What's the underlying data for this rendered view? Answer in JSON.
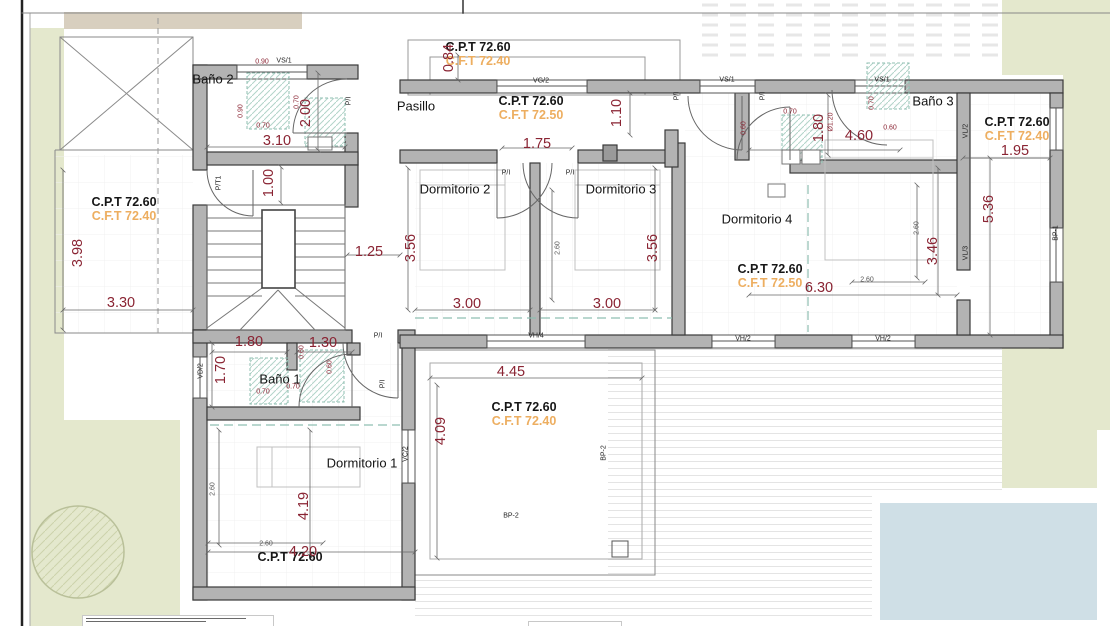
{
  "drawing": {
    "type": "architectural floor plan (upper level)",
    "rooms": [
      "Baño 2",
      "Pasillo",
      "Dormitorio 2",
      "Dormitorio 3",
      "Dormitorio 4",
      "Baño 3",
      "Baño 1",
      "Dormitorio 1"
    ],
    "colors": {
      "dimension_red": "#8a2433",
      "cft_orange": "#edae60",
      "wall_gray": "#b3b3b3",
      "garden_green": "#e4e8cd",
      "pool_blue": "#cfdfe6",
      "fixture_teal": "#8fbfb2"
    }
  },
  "labels": [
    {
      "name": "room-bano2",
      "text": "Baño 2",
      "x": 213,
      "y": 79,
      "cls": "room"
    },
    {
      "name": "room-pasillo",
      "text": "Pasillo",
      "x": 416,
      "y": 106,
      "cls": "room"
    },
    {
      "name": "room-dormitorio2",
      "text": "Dormitorio 2",
      "x": 455,
      "y": 189,
      "cls": "room"
    },
    {
      "name": "room-dormitorio3",
      "text": "Dormitorio 3",
      "x": 621,
      "y": 189,
      "cls": "room"
    },
    {
      "name": "room-dormitorio4",
      "text": "Dormitorio 4",
      "x": 757,
      "y": 219,
      "cls": "room"
    },
    {
      "name": "room-bano3",
      "text": "Baño 3",
      "x": 933,
      "y": 101,
      "cls": "room"
    },
    {
      "name": "room-bano1",
      "text": "Baño 1",
      "x": 280,
      "y": 379,
      "cls": "room"
    },
    {
      "name": "room-dormitorio1",
      "text": "Dormitorio 1",
      "x": 362,
      "y": 463,
      "cls": "room"
    },
    {
      "name": "cpt-top-porch",
      "text": "C.P.T 72.60",
      "x": 478,
      "y": 47,
      "cls": "cpt"
    },
    {
      "name": "cft-top-porch",
      "text": "C.F.T 72.40",
      "x": 478,
      "y": 61,
      "cls": "cft"
    },
    {
      "name": "cpt-pasillo",
      "text": "C.P.T 72.60",
      "x": 531,
      "y": 101,
      "cls": "cpt"
    },
    {
      "name": "cft-pasillo",
      "text": "C.F.T 72.50",
      "x": 531,
      "y": 115,
      "cls": "cft"
    },
    {
      "name": "cpt-left-porch",
      "text": "C.P.T 72.60",
      "x": 124,
      "y": 202,
      "cls": "cpt"
    },
    {
      "name": "cft-left-porch",
      "text": "C.F.T 72.40",
      "x": 124,
      "y": 216,
      "cls": "cft"
    },
    {
      "name": "cpt-dormitorio4",
      "text": "C.P.T 72.60",
      "x": 770,
      "y": 269,
      "cls": "cpt"
    },
    {
      "name": "cft-dormitorio4",
      "text": "C.F.T 72.50",
      "x": 770,
      "y": 283,
      "cls": "cft"
    },
    {
      "name": "cpt-right-terrace",
      "text": "C.P.T 72.60",
      "x": 1017,
      "y": 122,
      "cls": "cpt"
    },
    {
      "name": "cft-right-terrace",
      "text": "C.F.T 72.40",
      "x": 1017,
      "y": 136,
      "cls": "cft"
    },
    {
      "name": "cpt-bottom-terrace",
      "text": "C.P.T 72.60",
      "x": 524,
      "y": 407,
      "cls": "cpt"
    },
    {
      "name": "cft-bottom-terrace",
      "text": "C.F.T 72.40",
      "x": 524,
      "y": 421,
      "cls": "cft"
    },
    {
      "name": "cpt-dormitorio1",
      "text": "C.P.T 72.60",
      "x": 290,
      "y": 557,
      "cls": "cpt"
    },
    {
      "name": "dim-bano2-width",
      "text": "3.10",
      "x": 277,
      "y": 141,
      "cls": "dim"
    },
    {
      "name": "dim-bano2-depth",
      "text": "2.00",
      "x": 306,
      "y": 113,
      "cls": "dim",
      "rot": 1
    },
    {
      "name": "dim-hall-width",
      "text": "1.00",
      "x": 269,
      "y": 183,
      "cls": "dim",
      "rot": 1
    },
    {
      "name": "dim-porch-depth",
      "text": "0.84",
      "x": 449,
      "y": 58,
      "cls": "dim",
      "rot": 1
    },
    {
      "name": "dim-corridor",
      "text": "1.10",
      "x": 617,
      "y": 113,
      "cls": "dim",
      "rot": 1
    },
    {
      "name": "dim-pasillo-doors",
      "text": "1.75",
      "x": 537,
      "y": 144,
      "cls": "dim"
    },
    {
      "name": "dim-dorm2-depth",
      "text": "3.56",
      "x": 411,
      "y": 248,
      "cls": "dim",
      "rot": 1
    },
    {
      "name": "dim-dorm3-depth",
      "text": "3.56",
      "x": 653,
      "y": 248,
      "cls": "dim",
      "rot": 1
    },
    {
      "name": "dim-dorm2-width",
      "text": "3.00",
      "x": 467,
      "y": 304,
      "cls": "dim"
    },
    {
      "name": "dim-dorm3-width",
      "text": "3.00",
      "x": 607,
      "y": 304,
      "cls": "dim"
    },
    {
      "name": "dim-stair-width",
      "text": "1.25",
      "x": 369,
      "y": 252,
      "cls": "dim"
    },
    {
      "name": "dim-leftporch-depth",
      "text": "3.98",
      "x": 78,
      "y": 253,
      "cls": "dim",
      "rot": 1
    },
    {
      "name": "dim-leftporch-width",
      "text": "3.30",
      "x": 121,
      "y": 303,
      "cls": "dim"
    },
    {
      "name": "dim-bano3-depth",
      "text": "1.80",
      "x": 819,
      "y": 128,
      "cls": "dim",
      "rot": 1
    },
    {
      "name": "dim-bano3-width",
      "text": "4.60",
      "x": 859,
      "y": 136,
      "cls": "dim"
    },
    {
      "name": "dim-dorm4-width",
      "text": "6.30",
      "x": 819,
      "y": 288,
      "cls": "dim"
    },
    {
      "name": "dim-dorm4-depth",
      "text": "3.46",
      "x": 933,
      "y": 251,
      "cls": "dim",
      "rot": 1
    },
    {
      "name": "dim-terrace1-depth",
      "text": "5.36",
      "x": 989,
      "y": 209,
      "cls": "dim",
      "rot": 1
    },
    {
      "name": "dim-terrace1-width",
      "text": "1.95",
      "x": 1015,
      "y": 151,
      "cls": "dim"
    },
    {
      "name": "dim-bano1-width-a",
      "text": "1.80",
      "x": 249,
      "y": 342,
      "cls": "dim"
    },
    {
      "name": "dim-bano1-width-b",
      "text": "1.30",
      "x": 323,
      "y": 343,
      "cls": "dim"
    },
    {
      "name": "dim-bano1-depth",
      "text": "1.70",
      "x": 221,
      "y": 370,
      "cls": "dim",
      "rot": 1
    },
    {
      "name": "dim-terrace2-width",
      "text": "4.45",
      "x": 511,
      "y": 372,
      "cls": "dim"
    },
    {
      "name": "dim-terrace2-depth",
      "text": "4.09",
      "x": 441,
      "y": 431,
      "cls": "dim",
      "rot": 1
    },
    {
      "name": "dim-dorm1-depth",
      "text": "4.19",
      "x": 304,
      "y": 506,
      "cls": "dim",
      "rot": 1
    },
    {
      "name": "dim-dorm1-width",
      "text": "4.20",
      "x": 303,
      "y": 552,
      "cls": "dim"
    },
    {
      "name": "dim-b2-shower-w",
      "text": "0.90",
      "x": 262,
      "y": 62,
      "cls": "dimsm"
    },
    {
      "name": "dim-b2-shower-d",
      "text": "0.90",
      "x": 241,
      "y": 111,
      "cls": "dimsm",
      "rot": 1
    },
    {
      "name": "dim-b2-fix-a",
      "text": "0.70",
      "x": 297,
      "y": 102,
      "cls": "dimsm",
      "rot": 1
    },
    {
      "name": "dim-b2-fix-b",
      "text": "0.70",
      "x": 263,
      "y": 126,
      "cls": "dimsm"
    },
    {
      "name": "dim-b3-fix-a",
      "text": "0.70",
      "x": 790,
      "y": 112,
      "cls": "dimsm"
    },
    {
      "name": "dim-b3-fix-b",
      "text": "0.70",
      "x": 872,
      "y": 103,
      "cls": "dimsm",
      "rot": 1
    },
    {
      "name": "dim-b3-fix-c",
      "text": "0.60",
      "x": 890,
      "y": 128,
      "cls": "dimsm"
    },
    {
      "name": "dim-b3-fix-d",
      "text": "0.60",
      "x": 744,
      "y": 128,
      "cls": "dimsm",
      "rot": 1
    },
    {
      "name": "dim-b3-shower-dia",
      "text": "Ø1.20",
      "x": 831,
      "y": 122,
      "cls": "dimsm",
      "rot": 1
    },
    {
      "name": "dim-b1-fix-a",
      "text": "0.70",
      "x": 263,
      "y": 392,
      "cls": "dimsm"
    },
    {
      "name": "dim-b1-fix-b",
      "text": "0.70",
      "x": 293,
      "y": 387,
      "cls": "dimsm"
    },
    {
      "name": "dim-b1-fix-c",
      "text": "0.60",
      "x": 330,
      "y": 367,
      "cls": "dimsm",
      "rot": 1
    },
    {
      "name": "dim-b1-fix-d",
      "text": "0.60",
      "x": 302,
      "y": 352,
      "cls": "dimsm",
      "rot": 1
    },
    {
      "name": "dim-d23-bed",
      "text": "2.60",
      "x": 558,
      "y": 248,
      "cls": "dimgray",
      "rot": 1
    },
    {
      "name": "dim-d4-bed-v",
      "text": "2.60",
      "x": 917,
      "y": 228,
      "cls": "dimgray",
      "rot": 1
    },
    {
      "name": "dim-d4-bed-h",
      "text": "2.60",
      "x": 867,
      "y": 280,
      "cls": "dimgray"
    },
    {
      "name": "dim-d1-bed-h",
      "text": "2.60",
      "x": 266,
      "y": 544,
      "cls": "dimgray"
    },
    {
      "name": "dim-d1-bed-v",
      "text": "2.60",
      "x": 213,
      "y": 489,
      "cls": "dimgray",
      "rot": 1
    },
    {
      "name": "tag-window-vs1-bano2",
      "text": "VS/1",
      "x": 284,
      "y": 61,
      "cls": "tag"
    },
    {
      "name": "tag-window-vg2",
      "text": "VG/2",
      "x": 541,
      "y": 81,
      "cls": "tag"
    },
    {
      "name": "tag-window-vs1-a",
      "text": "VS/1",
      "x": 727,
      "y": 80,
      "cls": "tag"
    },
    {
      "name": "tag-window-vs1-b",
      "text": "VS/1",
      "x": 882,
      "y": 80,
      "cls": "tag"
    },
    {
      "name": "tag-window-vl2",
      "text": "VL/2",
      "x": 966,
      "y": 131,
      "cls": "tag",
      "rot": 1
    },
    {
      "name": "tag-window-vl3",
      "text": "VL/3",
      "x": 966,
      "y": 253,
      "cls": "tag",
      "rot": 1
    },
    {
      "name": "tag-bp1",
      "text": "BP-1",
      "x": 1056,
      "y": 233,
      "cls": "tag",
      "rot": 1
    },
    {
      "name": "tag-window-vh2-a",
      "text": "VH/2",
      "x": 743,
      "y": 339,
      "cls": "tag"
    },
    {
      "name": "tag-window-vh2-b",
      "text": "VH/2",
      "x": 883,
      "y": 339,
      "cls": "tag"
    },
    {
      "name": "tag-window-vh4",
      "text": "VH/4",
      "x": 536,
      "y": 336,
      "cls": "tag"
    },
    {
      "name": "tag-window-vc2",
      "text": "VC/2",
      "x": 406,
      "y": 454,
      "cls": "tag",
      "rot": 1
    },
    {
      "name": "tag-window-vd2",
      "text": "VD/2",
      "x": 201,
      "y": 371,
      "cls": "tag",
      "rot": 1
    },
    {
      "name": "tag-bp2-a",
      "text": "BP-2",
      "x": 511,
      "y": 516,
      "cls": "tag"
    },
    {
      "name": "tag-bp2-b",
      "text": "BP-2",
      "x": 604,
      "y": 453,
      "cls": "tag",
      "rot": 1
    },
    {
      "name": "tag-door-pt1",
      "text": "P/T1",
      "x": 219,
      "y": 183,
      "cls": "tag",
      "rot": 1
    },
    {
      "name": "tag-door-pi-bano2",
      "text": "P/I",
      "x": 349,
      "y": 101,
      "cls": "tag",
      "rot": 1
    },
    {
      "name": "tag-door-pi-dorm2",
      "text": "P/I",
      "x": 506,
      "y": 173,
      "cls": "tag"
    },
    {
      "name": "tag-door-pi-dorm3",
      "text": "P/I",
      "x": 570,
      "y": 173,
      "cls": "tag"
    },
    {
      "name": "tag-door-pi-dorm4",
      "text": "P/I",
      "x": 677,
      "y": 96,
      "cls": "tag",
      "rot": 1
    },
    {
      "name": "tag-door-pi-bano3",
      "text": "P/I",
      "x": 763,
      "y": 96,
      "cls": "tag",
      "rot": 1
    },
    {
      "name": "tag-door-pi-dorm1",
      "text": "P/I",
      "x": 378,
      "y": 336,
      "cls": "tag"
    },
    {
      "name": "tag-door-pi-bano1",
      "text": "P/I",
      "x": 383,
      "y": 384,
      "cls": "tag",
      "rot": 1
    }
  ]
}
